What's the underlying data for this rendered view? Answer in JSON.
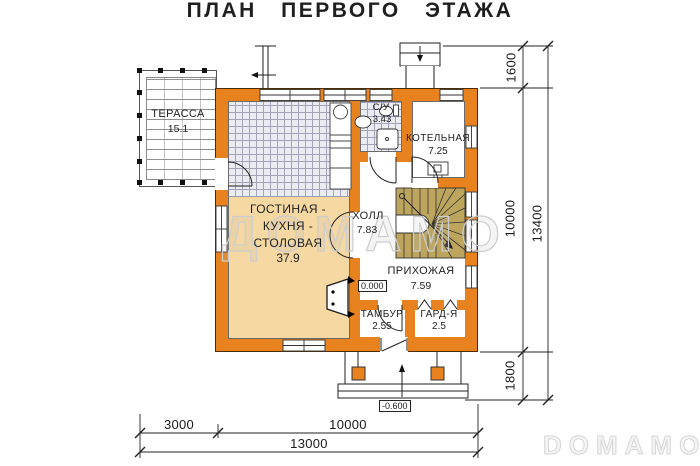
{
  "title": "ПЛАН ПЕРВОГО ЭТАЖА",
  "watermarks": {
    "center": "ДОМАМО",
    "corner": "DOMAMO"
  },
  "rooms": {
    "terrace": {
      "name": "ТЕРАССА",
      "area": "15.1"
    },
    "living": {
      "name": "ГОСТИНАЯ -\nКУХНЯ -\nСТОЛОВАЯ",
      "area": "37.9"
    },
    "bathroom": {
      "name": "С/У",
      "area": "3.43"
    },
    "boiler": {
      "name": "КОТЕЛЬНАЯ",
      "area": "7.25"
    },
    "hall": {
      "name": "ХОЛЛ",
      "area": "7.83"
    },
    "entry_hall": {
      "name": "ПРИХОЖАЯ",
      "area": "7.59"
    },
    "vestibule": {
      "name": "ТАМБУР",
      "area": "2.55"
    },
    "wardrobe": {
      "name": "ГАРД-Я",
      "area": "2.5"
    }
  },
  "levels": {
    "floor": "0.000",
    "porch": "-0.600"
  },
  "dimensions": {
    "right": {
      "top": "1600",
      "middle": "10000",
      "bottom": "1800",
      "total": "13400"
    },
    "bottom": {
      "left": "3000",
      "right": "10000",
      "total": "13000"
    }
  },
  "colors": {
    "wall": "#E8821F",
    "living_floor": "#F6D8A2",
    "stairs": "#BEA55E"
  }
}
